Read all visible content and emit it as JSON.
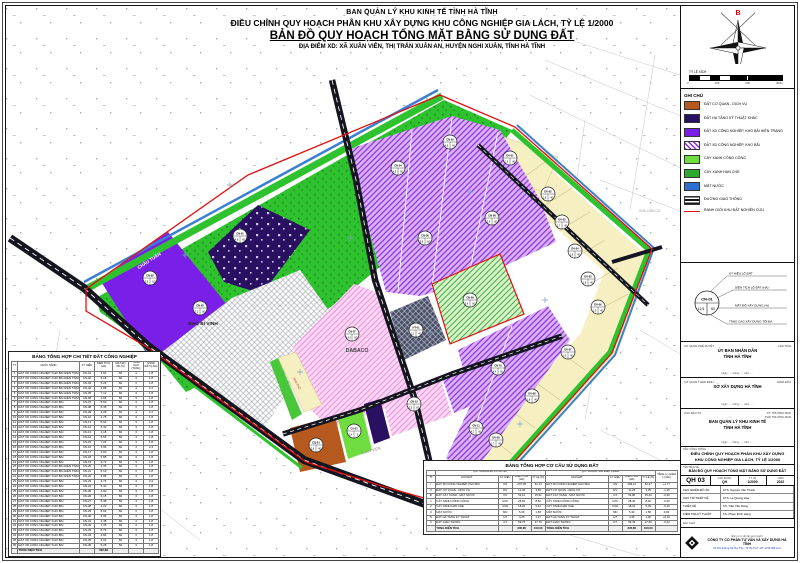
{
  "header": {
    "org": "BAN QUẢN LÝ KHU KINH TẾ TỈNH HÀ TĨNH",
    "project": "ĐIỀU CHỈNH QUY HOẠCH PHÂN KHU XÂY DỰNG KHU CÔNG NGHIỆP GIA LÁCH, TỶ LỆ 1/2000",
    "title": "BẢN ĐỒ QUY HOẠCH TỔNG MẶT BẰNG SỬ DỤNG ĐẤT",
    "location": "ĐỊA ĐIỂM XD: XÃ XUÂN VIÊN, THỊ TRẤN XUÂN AN, HUYỆN NGHI XUÂN, TỈNH HÀ TĨNH"
  },
  "compass": {
    "north": "B",
    "scale_label": "TỶ LỆ XÍCH",
    "ticks": [
      "0",
      "100",
      "200",
      "400m"
    ]
  },
  "legend": {
    "title": "GHI CHÚ",
    "items": [
      {
        "label": "ĐẤT CƠ QUAN - DỊCH VỤ",
        "swatch": "solid",
        "color": "#b5591f"
      },
      {
        "label": "ĐẤT HẠ TẦNG KỸ THUẬT KHÁC",
        "swatch": "solid",
        "color": "#2a1060"
      },
      {
        "label": "ĐẤT XD CÔNG NGHIỆP, KHO BÃI HIỆN TRẠNG",
        "swatch": "solid",
        "color": "#7a1fe8"
      },
      {
        "label": "ĐẤT XD CÔNG NGHIỆP, KHO BÃI",
        "swatch": "hatch",
        "color": "#8d2be0"
      },
      {
        "label": "CÂY XANH CÔNG CỘNG",
        "swatch": "solid",
        "color": "#6fdd3f"
      },
      {
        "label": "CÂY XANH HẠN CHẾ",
        "swatch": "solid",
        "color": "#2ea82e"
      },
      {
        "label": "MẶT NƯỚC",
        "swatch": "solid",
        "color": "#2f6fd0"
      },
      {
        "label": "ĐƯỜNG GIAO THÔNG",
        "swatch": "road",
        "color": "#15151f"
      },
      {
        "label": "RANH GIỚI KHU ĐẤT NGHIÊN CỨU",
        "swatch": "line",
        "color": "#e01010"
      }
    ]
  },
  "lot_symbol": {
    "circle": {
      "code": "CN-01",
      "area": "12,5",
      "density": "60"
    },
    "callouts": [
      "KÝ HIỆU LÔ ĐẤT",
      "DIỆN TÍCH LÔ ĐẤT (HA)",
      "MẬT ĐỘ XÂY DỰNG (%)",
      "TẦNG CAO XÂY DỰNG TỐI ĐA"
    ]
  },
  "approvals": [
    {
      "label": "CƠ QUAN PHÊ DUYỆT",
      "right": "CHỦ TỊCH",
      "name1": "ỦY BAN NHÂN DÂN",
      "name2": "TỈNH HÀ TĨNH",
      "date": "Ngày ..... tháng ..... năm ....."
    },
    {
      "label": "CƠ QUAN THẨM ĐỊNH",
      "right": "GIÁM ĐỐC",
      "name1": "SỞ XÂY DỰNG HÀ TĨNH",
      "name2": "",
      "date": "Ngày ..... tháng ..... năm ....."
    },
    {
      "label": "CHỦ ĐẦU TƯ",
      "right": "KT. TRƯỞNG BAN\nPHÓ TRƯỞNG BAN",
      "name1": "BAN QUẢN LÝ KHU KINH TẾ",
      "name2": "TỈNH HÀ TĨNH",
      "date": "Ngày ..... tháng ..... năm ....."
    }
  ],
  "titleblock": {
    "project_label": "TÊN CÔNG TRÌNH",
    "project1": "ĐIỀU CHỈNH QUY HOẠCH PHÂN KHU XÂY DỰNG",
    "project2": "KHU CÔNG NGHIỆP GIA LÁCH, TỶ LỆ 1/2000",
    "drawing_label": "TÊN BẢN VẼ",
    "drawing": "BẢN ĐỒ QUY HOẠCH TỔNG MẶT BẰNG SỬ DỤNG ĐẤT",
    "number": "QH 03",
    "stage_label": "GIAI ĐOẠN",
    "stage": "QH",
    "scale_label": "TỶ LỆ",
    "scale": "1/2000",
    "year_label": "NĂM",
    "year": "2022",
    "staff": [
      [
        "CHỦ NHIỆM ĐỒ ÁN",
        "KTS. Nguyễn Văn Thành"
      ],
      [
        "CHỦ TRÌ THIẾT KẾ",
        "KTS. Lê Quang Hòa"
      ],
      [
        "THIẾT KẾ",
        "KS. Trần Văn Dũng"
      ],
      [
        "KIỂM TRA KỸ THUẬT",
        "KS. Phạm Đình Hùng"
      ]
    ],
    "note_label": "GHI CHÚ:"
  },
  "company": {
    "unit_label": "(Đơn vị tư vấn lập quy hoạch)",
    "name": "CÔNG TY CỔ PHẦN TƯ VẤN VÀ XÂY DỰNG HÀ TĨNH",
    "address": "Số 181 đường Hà Huy Tập - TP Hà Tĩnh - ĐT: 0239.385.xxxx"
  },
  "map": {
    "lots": [
      {
        "x": 150,
        "y": 278,
        "c": "CN-02",
        "a": "5,6",
        "d": "60"
      },
      {
        "x": 200,
        "y": 308,
        "c": "CN-03",
        "a": "7,2",
        "d": "60"
      },
      {
        "x": 240,
        "y": 236,
        "c": "CN-01",
        "a": "4,8",
        "d": "60"
      },
      {
        "x": 352,
        "y": 334,
        "c": "CN-07",
        "a": "14,6",
        "d": "60"
      },
      {
        "x": 416,
        "y": 330,
        "c": "HT-01",
        "a": "1,2",
        "d": "40"
      },
      {
        "x": 470,
        "y": 300,
        "c": "CN-09",
        "a": "5,4",
        "d": "60"
      },
      {
        "x": 398,
        "y": 168,
        "c": "CN-04",
        "a": "6,5",
        "d": "60"
      },
      {
        "x": 450,
        "y": 142,
        "c": "CN-05",
        "a": "4,9",
        "d": "60"
      },
      {
        "x": 425,
        "y": 238,
        "c": "CN-06",
        "a": "5,8",
        "d": "60"
      },
      {
        "x": 492,
        "y": 218,
        "c": "CN-08",
        "a": "3,6",
        "d": "60"
      },
      {
        "x": 498,
        "y": 368,
        "c": "CN-10",
        "a": "6,4",
        "d": "60"
      },
      {
        "x": 476,
        "y": 428,
        "c": "CN-11",
        "a": "4,2",
        "d": "60"
      },
      {
        "x": 316,
        "y": 445,
        "c": "CQ-01",
        "a": "2,8",
        "d": "40"
      },
      {
        "x": 354,
        "y": 431,
        "c": "CX-01",
        "a": "1,4",
        "d": "5"
      },
      {
        "x": 414,
        "y": 404,
        "c": "CN-12",
        "a": "3,5",
        "d": "60"
      },
      {
        "x": 510,
        "y": 158,
        "c": "DV-01",
        "a": "1,6",
        "d": "40"
      },
      {
        "x": 548,
        "y": 194,
        "c": "DV-02",
        "a": "1,8",
        "d": "40"
      },
      {
        "x": 562,
        "y": 222,
        "c": "DV-03",
        "a": "1,7",
        "d": "40"
      },
      {
        "x": 575,
        "y": 251,
        "c": "DV-04",
        "a": "1,8",
        "d": "40"
      },
      {
        "x": 588,
        "y": 279,
        "c": "DV-05",
        "a": "1,6",
        "d": "40"
      },
      {
        "x": 598,
        "y": 307,
        "c": "DV-06",
        "a": "1,5",
        "d": "40"
      },
      {
        "x": 568,
        "y": 352,
        "c": "DV-07",
        "a": "1,9",
        "d": "40"
      },
      {
        "x": 532,
        "y": 396,
        "c": "DV-08",
        "a": "1,8",
        "d": "40"
      },
      {
        "x": 496,
        "y": 440,
        "c": "DV-09",
        "a": "1,7",
        "d": "40"
      }
    ],
    "labels": [
      {
        "x": 150,
        "y": 262,
        "t": "CHÂU TUẤN",
        "s": 4.5,
        "c": "#ffffff",
        "r": -33,
        "b": 1
      },
      {
        "x": 203,
        "y": 325,
        "t": "BAO BÌ VINH",
        "s": 4.8,
        "c": "#222222",
        "r": 0,
        "b": 1
      },
      {
        "x": 357,
        "y": 352,
        "t": "DABACO",
        "s": 5.2,
        "c": "#444444",
        "r": 0,
        "b": 1
      },
      {
        "x": 650,
        "y": 212,
        "t": "KHU DÂN CƯ",
        "s": 3.4,
        "c": "#999999",
        "r": 0,
        "b": 0
      },
      {
        "x": 371,
        "y": 452,
        "t": "XUÂN VIÊN",
        "s": 3.8,
        "c": "#888888",
        "r": -16,
        "b": 0
      },
      {
        "x": 66,
        "y": 436,
        "t": "XUÂN AN",
        "s": 3.8,
        "c": "#888888",
        "r": 0,
        "b": 0
      },
      {
        "x": 296,
        "y": 384,
        "t": "NHÀ PHỐ",
        "s": 2.8,
        "c": "#aa2222",
        "r": 62,
        "b": 0
      }
    ]
  },
  "tables": {
    "industrial": {
      "title": "BẢNG TỔNG HỢP CHI TIẾT ĐẤT CÔNG NGHIỆP",
      "cols": [
        "TT",
        "CHỨC NĂNG",
        "KÝ HIỆU",
        "DIỆN TÍCH (HA)",
        "MẬT ĐỘ XD (%)",
        "TẦNG CAO (TẦNG)",
        "HSSD ĐẤT (LẦN)"
      ],
      "rows": [
        [
          "1",
          "ĐẤT XD CÔNG NGHIỆP, KHO BÃI HIỆN TRẠNG",
          "CN-01",
          "4,52",
          "60",
          "3",
          "1,8"
        ],
        [
          "2",
          "ĐẤT XD CÔNG NGHIỆP, KHO BÃI HIỆN TRẠNG",
          "CN-02",
          "6,18",
          "60",
          "3",
          "1,8"
        ],
        [
          "3",
          "ĐẤT XD CÔNG NGHIỆP, KHO BÃI HIỆN TRẠNG",
          "CN-03",
          "5,24",
          "60",
          "3",
          "1,8"
        ],
        [
          "4",
          "ĐẤT XD CÔNG NGHIỆP, KHO BÃI HIỆN TRẠNG",
          "CN-04",
          "3,85",
          "60",
          "4",
          "2,4"
        ],
        [
          "5",
          "ĐẤT XD CÔNG NGHIỆP, KHO BÃI HIỆN TRẠNG",
          "CN-05",
          "7,12",
          "60",
          "3",
          "1,8"
        ],
        [
          "6",
          "ĐẤT XD CÔNG NGHIỆP, KHO BÃI HIỆN TRẠNG",
          "CN-06",
          "4,96",
          "60",
          "3",
          "1,8"
        ],
        [
          "7",
          "ĐẤT XD CÔNG NGHIỆP, KHO BÃI",
          "CN-07",
          "5,60",
          "60",
          "3",
          "1,8"
        ],
        [
          "8",
          "ĐẤT XD CÔNG NGHIỆP, KHO BÃI",
          "CN-08",
          "6,45",
          "60",
          "3",
          "1,8"
        ],
        [
          "9",
          "ĐẤT XD CÔNG NGHIỆP, KHO BÃI",
          "CN-09",
          "3,28",
          "60",
          "4",
          "2,4"
        ],
        [
          "10",
          "ĐẤT XD CÔNG NGHIỆP, KHO BÃI",
          "CN-10",
          "4,75",
          "60",
          "3",
          "1,8"
        ],
        [
          "11",
          "ĐẤT XD CÔNG NGHIỆP, KHO BÃI",
          "CN-11",
          "5,92",
          "60",
          "3",
          "1,8"
        ],
        [
          "12",
          "ĐẤT XD CÔNG NGHIỆP, KHO BÃI",
          "CN-12",
          "6,30",
          "60",
          "3",
          "1,8"
        ],
        [
          "13",
          "ĐẤT XD CÔNG NGHIỆP, KHO BÃI",
          "CN-13",
          "4,18",
          "60",
          "3",
          "1,8"
        ],
        [
          "14",
          "ĐẤT XD CÔNG NGHIỆP, KHO BÃI",
          "CN-14",
          "5,55",
          "60",
          "3",
          "1,8"
        ],
        [
          "15",
          "ĐẤT XD CÔNG NGHIỆP, KHO BÃI",
          "CN-15",
          "7,24",
          "60",
          "3",
          "1,8"
        ],
        [
          "16",
          "ĐẤT XD CÔNG NGHIỆP, KHO BÃI",
          "CN-16",
          "3,96",
          "60",
          "4",
          "2,4"
        ],
        [
          "17",
          "ĐẤT XD CÔNG NGHIỆP, KHO BÃI",
          "CN-17",
          "4,60",
          "60",
          "3",
          "1,8"
        ],
        [
          "18",
          "ĐẤT XD CÔNG NGHIỆP, KHO BÃI",
          "CN-18",
          "5,85",
          "60",
          "3",
          "1,8"
        ],
        [
          "19",
          "ĐẤT XD CÔNG NGHIỆP, KHO BÃI",
          "CN-19",
          "6,72",
          "60",
          "3",
          "1,8"
        ],
        [
          "20",
          "ĐẤT XD CÔNG NGHIỆP, KHO BÃI HIỆN TRẠNG",
          "CN-20",
          "4,35",
          "60",
          "3",
          "1,8"
        ],
        [
          "21",
          "ĐẤT XD CÔNG NGHIỆP, KHO BÃI HIỆN TRẠNG",
          "CN-21",
          "5,10",
          "60",
          "3",
          "1,8"
        ],
        [
          "22",
          "ĐẤT XD CÔNG NGHIỆP, KHO BÃI HIỆN TRẠNG",
          "CN-22",
          "6,88",
          "60",
          "3",
          "1,8"
        ],
        [
          "23",
          "ĐẤT XD CÔNG NGHIỆP, KHO BÃI",
          "CN-23",
          "3,74",
          "60",
          "4",
          "2,4"
        ],
        [
          "24",
          "ĐẤT XD CÔNG NGHIỆP, KHO BÃI",
          "CN-24",
          "5,42",
          "60",
          "3",
          "1,8"
        ],
        [
          "25",
          "ĐẤT XD CÔNG NGHIỆP, KHO BÃI",
          "CN-25",
          "4,90",
          "60",
          "3",
          "1,8"
        ],
        [
          "26",
          "ĐẤT XD CÔNG NGHIỆP, KHO BÃI",
          "CN-26",
          "6,15",
          "60",
          "3",
          "1,8"
        ],
        [
          "27",
          "ĐẤT XD CÔNG NGHIỆP, KHO BÃI",
          "CN-27",
          "5,38",
          "60",
          "3",
          "1,8"
        ],
        [
          "28",
          "ĐẤT XD CÔNG NGHIỆP, KHO BÃI",
          "CN-28",
          "4,22",
          "60",
          "3",
          "1,8"
        ],
        [
          "29",
          "ĐẤT XD CÔNG NGHIỆP, KHO BÃI",
          "CN-29",
          "6,64",
          "60",
          "3",
          "1,8"
        ],
        [
          "30",
          "ĐẤT XD CÔNG NGHIỆP, KHO BÃI",
          "CN-30",
          "5,05",
          "60",
          "3",
          "1,8"
        ],
        [
          "31",
          "ĐẤT XD CÔNG NGHIỆP, KHO BÃI",
          "CN-31",
          "4,48",
          "60",
          "3",
          "1,8"
        ],
        [
          "32",
          "ĐẤT XD CÔNG NGHIỆP, KHO BÃI",
          "CN-32",
          "7,35",
          "60",
          "3",
          "1,8"
        ],
        [
          "33",
          "ĐẤT XD CÔNG NGHIỆP, KHO BÃI",
          "CN-33",
          "5,76",
          "60",
          "3",
          "1,8"
        ],
        [
          "34",
          "ĐẤT XD CÔNG NGHIỆP, KHO BÃI",
          "CN-34",
          "4,84",
          "60",
          "3",
          "1,8"
        ],
        [
          "35",
          "ĐẤT XD CÔNG NGHIỆP, KHO BÃI",
          "CN-35",
          "6,02",
          "60",
          "3",
          "1,8"
        ],
        [
          "36",
          "ĐẤT XD CÔNG NGHIỆP, KHO BÃI",
          "CN-36",
          "5,28",
          "60",
          "3",
          "1,8"
        ],
        [
          "",
          "TỔNG DIỆN TÍCH",
          "",
          "192,83",
          "",
          "",
          ""
        ]
      ]
    },
    "structure": {
      "title": "BẢNG TỔNG HỢP CƠ CẤU SỬ DỤNG ĐẤT",
      "group1": "QUY HOẠCH ĐƯỢC DUYỆT",
      "group2": "QUY HOẠCH SAU ĐIỀU CHỈNH",
      "group3": "TĂNG (+) GIẢM (-) (HA)",
      "cols": [
        "TT",
        "LOẠI ĐẤT",
        "KÝ HIỆU",
        "DIỆN TÍCH (HA)",
        "TỶ LỆ (%)",
        "LOẠI ĐẤT",
        "KÝ HIỆU",
        "DIỆN TÍCH (HA)",
        "TỶ LỆ (%)"
      ],
      "rows": [
        [
          "I",
          "ĐẤT XD CÔNG NGHIỆP, KHO BÃI",
          "CN",
          "207,35",
          "61,74",
          "ĐẤT XD CÔNG NGHIỆP, KHO BÃI",
          "CN",
          "209,12",
          "62,27",
          "+1,77"
        ],
        [
          "II",
          "ĐẤT CƠ QUAN - DỊCH VỤ",
          "DV",
          "12,40",
          "3,69",
          "ĐẤT CƠ QUAN - DỊCH VỤ",
          "DV",
          "11,25",
          "3,35",
          "-1,15"
        ],
        [
          "III",
          "ĐẤT CÂY XANH - MẶT NƯỚC",
          "CX",
          "52,10",
          "15,51",
          "ĐẤT CÂY XANH - MẶT NƯỚC",
          "CX",
          "51,80",
          "15,42",
          "-0,30"
        ],
        [
          "1",
          "CÂY XANH CÔNG CỘNG",
          "CXC",
          "28,60",
          "8,52",
          "CÂY XANH CÔNG CỘNG",
          "CXC",
          "28,40",
          "8,46",
          "-0,20"
        ],
        [
          "2",
          "CÂY XANH HẠN CHẾ",
          "CXH",
          "18,20",
          "5,42",
          "CÂY XANH HẠN CHẾ",
          "CXH",
          "18,10",
          "5,39",
          "-0,10"
        ],
        [
          "3",
          "MẶT NƯỚC",
          "MN",
          "5,30",
          "1,58",
          "MẶT NƯỚC",
          "MN",
          "5,30",
          "1,58",
          "0,00"
        ],
        [
          "IV",
          "ĐẤT HẠ TẦNG KỸ THUẬT",
          "HT",
          "4,25",
          "1,27",
          "ĐẤT HẠ TẦNG KỸ THUẬT",
          "HT",
          "4,35",
          "1,30",
          "+0,10"
        ],
        [
          "V",
          "ĐẤT GIAO THÔNG",
          "GT",
          "59,75",
          "17,79",
          "ĐẤT GIAO THÔNG",
          "GT",
          "59,33",
          "17,66",
          "-0,42"
        ],
        [
          "",
          "TỔNG DIỆN TÍCH",
          "",
          "335,85",
          "100,00",
          "TỔNG DIỆN TÍCH",
          "",
          "335,85",
          "100,00",
          ""
        ]
      ]
    }
  }
}
